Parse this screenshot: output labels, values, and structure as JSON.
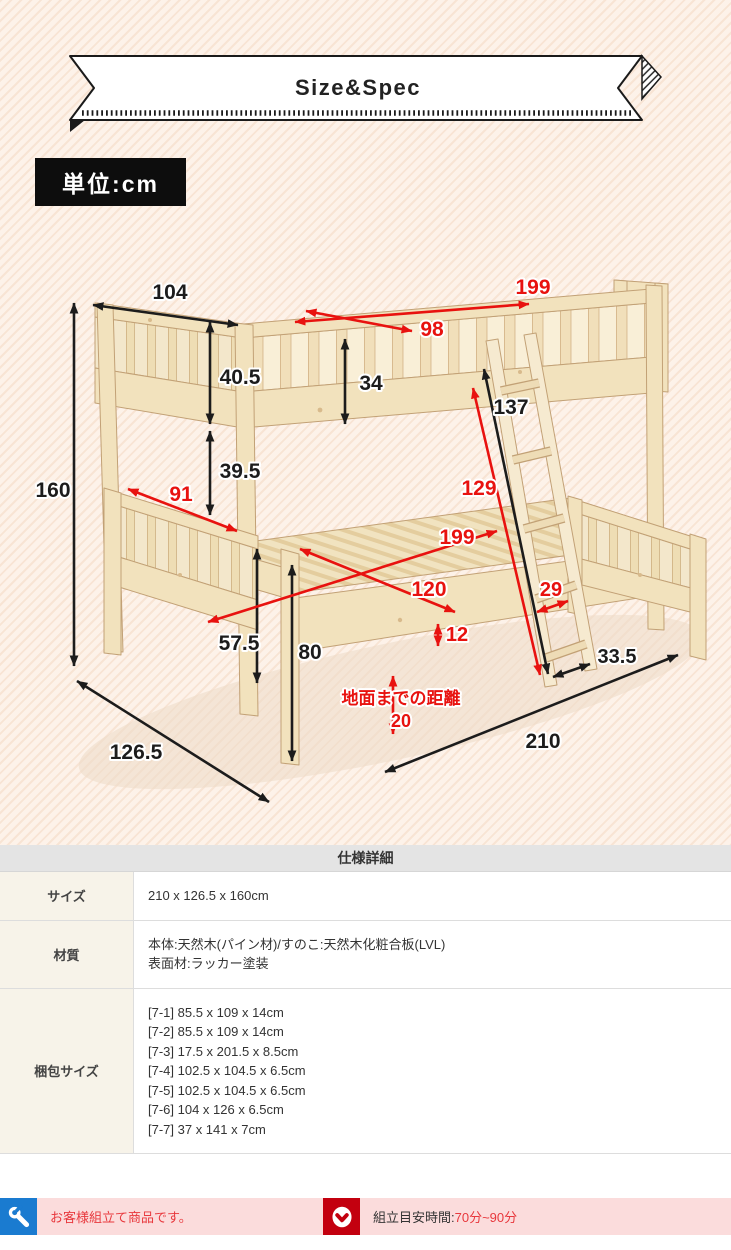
{
  "header": {
    "ribbon_label": "Size&Spec",
    "unit_badge": "単位:cm"
  },
  "colors": {
    "background_peach": "#fdf2e9",
    "arrow_black": "#1c1c1c",
    "arrow_red": "#e8120f",
    "notice_pink": "#fbdcdc",
    "notice_blue": "#1a7bd0",
    "notice_red": "#c3000f",
    "notice_text_red": "#e8383d"
  },
  "diagram": {
    "unit": "cm",
    "dimensions": [
      {
        "label": "160",
        "color": "black",
        "arrow": [
          74,
          303,
          74,
          666
        ],
        "pos": [
          53,
          497
        ],
        "size": 21
      },
      {
        "label": "104",
        "color": "black",
        "arrow": [
          93,
          305,
          238,
          325
        ],
        "pos": [
          170,
          299
        ],
        "size": 21
      },
      {
        "label": "40.5",
        "color": "black",
        "arrow": [
          210,
          322,
          210,
          424
        ],
        "pos": [
          240,
          384
        ],
        "size": 21
      },
      {
        "label": "34",
        "color": "black",
        "arrow": [
          345,
          339,
          345,
          424
        ],
        "pos": [
          371,
          390
        ],
        "size": 21
      },
      {
        "label": "39.5",
        "color": "black",
        "arrow": [
          210,
          431,
          210,
          515
        ],
        "pos": [
          240,
          478
        ],
        "size": 21
      },
      {
        "label": "137",
        "color": "black",
        "arrow": [
          484,
          369,
          548,
          674
        ],
        "pos": [
          511,
          414
        ],
        "size": 21
      },
      {
        "label": "57.5",
        "color": "black",
        "arrow": [
          257,
          549,
          257,
          683
        ],
        "pos": [
          239,
          650
        ],
        "size": 21
      },
      {
        "label": "80",
        "color": "black",
        "arrow": [
          292,
          565,
          292,
          761
        ],
        "pos": [
          310,
          659
        ],
        "size": 21
      },
      {
        "label": "33.5",
        "color": "black",
        "arrow": [
          553,
          677,
          590,
          664
        ],
        "pos": [
          617,
          663
        ],
        "size": 20
      },
      {
        "label": "210",
        "color": "black",
        "arrow": [
          385,
          772,
          678,
          655
        ],
        "pos": [
          543,
          748
        ],
        "size": 21
      },
      {
        "label": "126.5",
        "color": "black",
        "arrow": [
          77,
          681,
          269,
          802
        ],
        "pos": [
          136,
          759
        ],
        "size": 21
      },
      {
        "label": "199",
        "color": "red",
        "arrow": [
          295,
          322,
          529,
          304
        ],
        "pos": [
          533,
          294
        ],
        "size": 21
      },
      {
        "label": "98",
        "color": "red",
        "arrow": [
          306,
          311,
          412,
          331
        ],
        "pos": [
          432,
          336
        ],
        "size": 21
      },
      {
        "label": "91",
        "color": "red",
        "arrow": [
          128,
          489,
          237,
          531
        ],
        "pos": [
          181,
          501
        ],
        "size": 21
      },
      {
        "label": "129",
        "color": "red",
        "arrow": [
          473,
          388,
          540,
          675
        ],
        "pos": [
          479,
          495
        ],
        "size": 21
      },
      {
        "label": "199",
        "color": "red",
        "arrow": [
          208,
          622,
          497,
          531
        ],
        "pos": [
          457,
          544
        ],
        "size": 21
      },
      {
        "label": "120",
        "color": "red",
        "arrow": [
          300,
          549,
          455,
          612
        ],
        "pos": [
          429,
          596
        ],
        "size": 21
      },
      {
        "label": "29",
        "color": "red",
        "arrow": [
          537,
          612,
          568,
          601
        ],
        "pos": [
          551,
          596
        ],
        "size": 20
      },
      {
        "label": "12",
        "color": "red",
        "arrow": [
          438,
          624,
          438,
          646
        ],
        "pos": [
          457,
          641
        ],
        "size": 20
      },
      {
        "label": "",
        "color": "red",
        "arrow": [
          393,
          676,
          393,
          734
        ]
      },
      {
        "label": "地面までの距離",
        "color": "red",
        "pos": [
          401,
          704
        ],
        "size": 17,
        "anchor": "start"
      },
      {
        "label": "20",
        "color": "red",
        "pos": [
          401,
          727
        ],
        "size": 18,
        "anchor": "start"
      }
    ]
  },
  "spec_table": {
    "title": "仕様詳細",
    "rows": [
      {
        "label": "サイズ",
        "lines": [
          "210 x 126.5 x 160cm"
        ]
      },
      {
        "label": "材質",
        "lines": [
          "本体:天然木(パイン材)/すのこ:天然木化粧合板(LVL)",
          "表面材:ラッカー塗装"
        ]
      },
      {
        "label": "梱包サイズ",
        "lines": [
          "[7-1] 85.5 x 109 x 14cm",
          "[7-2] 85.5 x 109 x 14cm",
          "[7-3] 17.5 x 201.5 x 8.5cm",
          "[7-4] 102.5 x 104.5 x 6.5cm",
          "[7-5] 102.5 x 104.5 x 6.5cm",
          "[7-6] 104 x 126 x 6.5cm",
          "[7-7] 37 x 141 x 7cm"
        ]
      }
    ]
  },
  "notices": {
    "assembly": {
      "icon": "wrench-icon",
      "text": "お客様組立て商品です。"
    },
    "time": {
      "icon": "clock-icon",
      "prefix": "組立目安時間:",
      "value": "70分~90分"
    }
  }
}
